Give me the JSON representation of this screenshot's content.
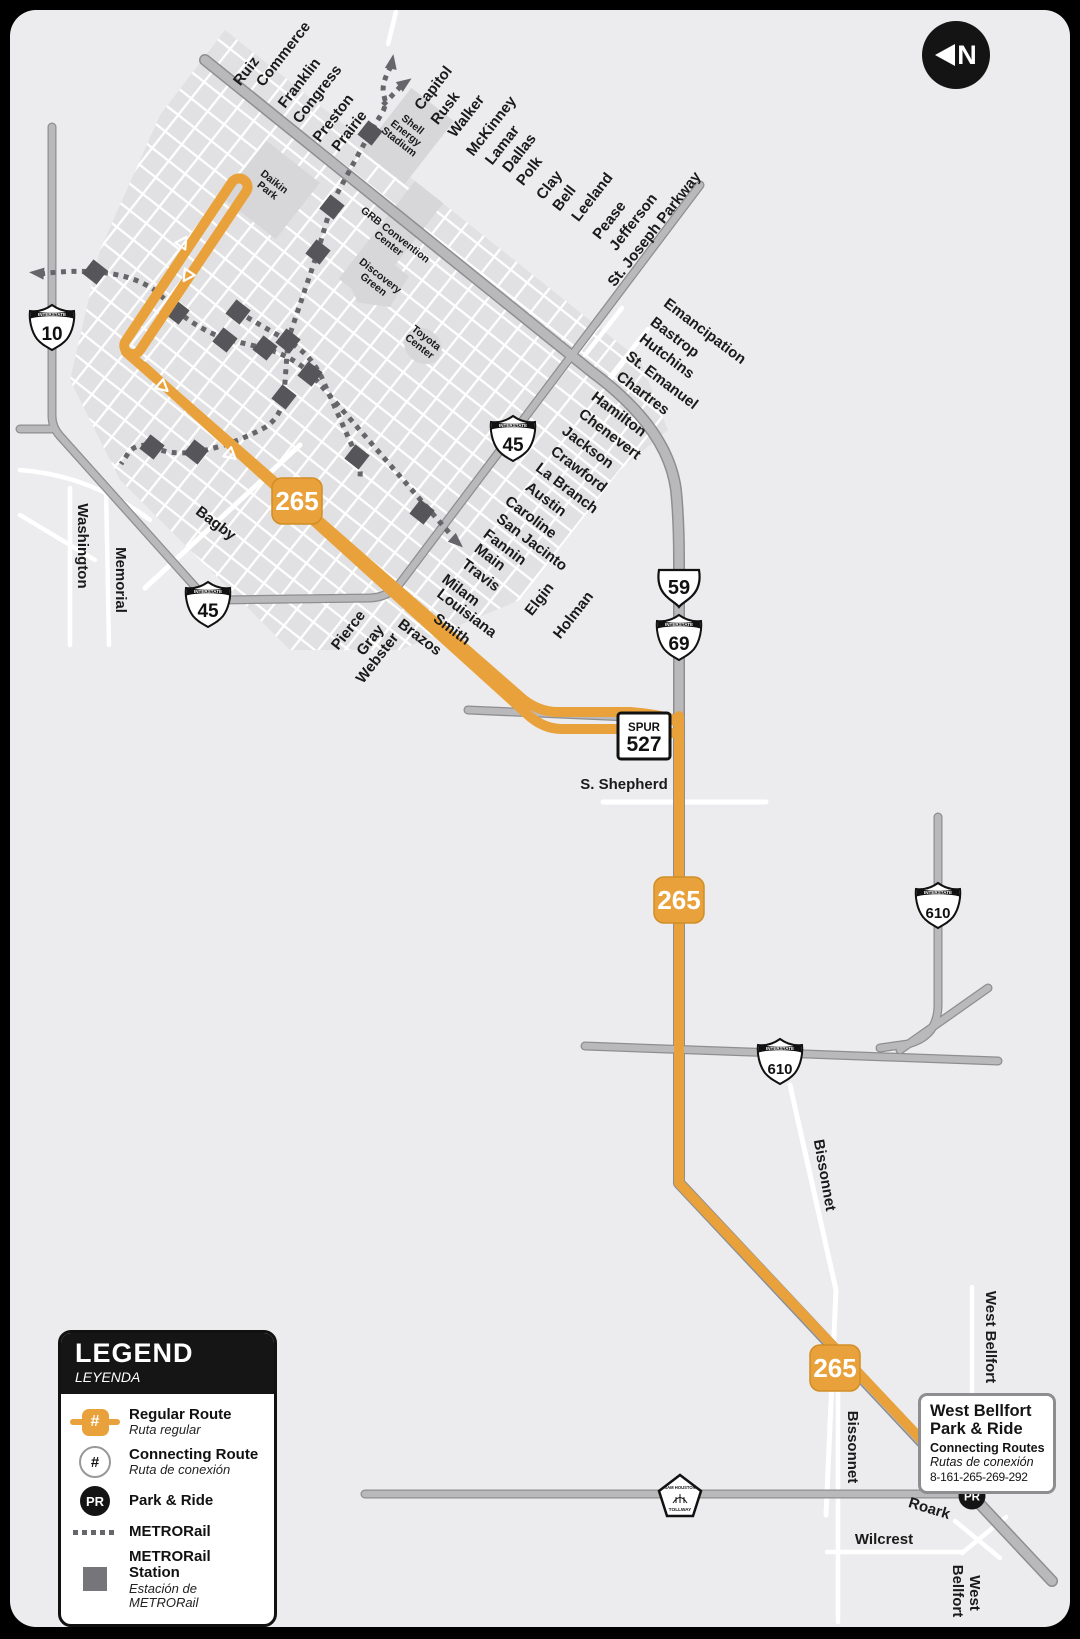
{
  "north": {
    "label": "N"
  },
  "colors": {
    "route_orange": "#E9A23B",
    "badge_border": "#D18E26",
    "road_gray": "#B9B9BC",
    "road_casing": "#8E8E91",
    "rail_gray": "#66666A",
    "map_background": "#ECECEE",
    "block_gray": "#E1E1E3",
    "panel_black": "#141414"
  },
  "legend": {
    "title": "LEGEND",
    "subtitle": "LEYENDA",
    "items": [
      {
        "icon": "regular-route-icon",
        "symbol": "#",
        "label": "Regular Route",
        "sublabel": "Ruta regular"
      },
      {
        "icon": "connecting-route-icon",
        "symbol": "#",
        "label": "Connecting Route",
        "sublabel": "Ruta de conexión"
      },
      {
        "icon": "park-and-ride-icon",
        "symbol": "PR",
        "label": "Park & Ride",
        "sublabel": ""
      },
      {
        "icon": "metrorail-icon",
        "symbol": "",
        "label": "METRORail",
        "sublabel": ""
      },
      {
        "icon": "metrorail-station-icon",
        "symbol": "",
        "label": "METRORail Station",
        "sublabel": "Estación de METRORail"
      }
    ]
  },
  "callout": {
    "line1": "West Bellfort",
    "line2": "Park & Ride",
    "line3": "Connecting Routes",
    "line4": "Rutas de conexión",
    "line5": "8-161-265-269-292"
  },
  "map": {
    "route_number": "265",
    "park_and_ride": {
      "x": 972,
      "y": 1496,
      "label": "PR"
    },
    "route_badges": [
      {
        "x": 297,
        "y": 501
      },
      {
        "x": 679,
        "y": 900
      },
      {
        "x": 835,
        "y": 1368
      }
    ],
    "shields": [
      {
        "type": "interstate",
        "banner": "INTERSTATE",
        "num": "10",
        "x": 52,
        "y": 327
      },
      {
        "type": "interstate",
        "banner": "INTERSTATE",
        "num": "45",
        "x": 513,
        "y": 438
      },
      {
        "type": "interstate",
        "banner": "INTERSTATE",
        "num": "45",
        "x": 208,
        "y": 604
      },
      {
        "type": "us",
        "num": "59",
        "x": 679,
        "y": 587
      },
      {
        "type": "interstate",
        "banner": "INTERSTATE",
        "num": "69",
        "x": 679,
        "y": 637
      },
      {
        "type": "interstate",
        "banner": "INTERSTATE",
        "num": "610",
        "x": 938,
        "y": 905
      },
      {
        "type": "interstate",
        "banner": "INTERSTATE",
        "num": "610",
        "x": 780,
        "y": 1061
      },
      {
        "type": "spur",
        "prefix": "SPUR",
        "num": "527",
        "x": 644,
        "y": 736
      },
      {
        "type": "toll",
        "line1": "SAM HOUSTON",
        "line2": "TOLLWAY",
        "x": 680,
        "y": 1497
      }
    ],
    "street_labels": [
      {
        "text": "Ruiz",
        "x": 250,
        "y": 74,
        "rot": -52
      },
      {
        "text": "Commerce",
        "x": 287,
        "y": 57,
        "rot": -52
      },
      {
        "text": "Franklin",
        "x": 303,
        "y": 86,
        "rot": -52
      },
      {
        "text": "Congress",
        "x": 321,
        "y": 97,
        "rot": -52
      },
      {
        "text": "Preston",
        "x": 337,
        "y": 121,
        "rot": -52
      },
      {
        "text": "Prairie",
        "x": 353,
        "y": 134,
        "rot": -52
      },
      {
        "text": "Capitol",
        "x": 437,
        "y": 91,
        "rot": -52
      },
      {
        "text": "Rusk",
        "x": 449,
        "y": 111,
        "rot": -52
      },
      {
        "text": "Walker",
        "x": 470,
        "y": 119,
        "rot": -52
      },
      {
        "text": "McKinney",
        "x": 495,
        "y": 129,
        "rot": -52
      },
      {
        "text": "Lamar",
        "x": 506,
        "y": 148,
        "rot": -52
      },
      {
        "text": "Dallas",
        "x": 523,
        "y": 156,
        "rot": -52
      },
      {
        "text": "Polk",
        "x": 533,
        "y": 174,
        "rot": -52
      },
      {
        "text": "Clay",
        "x": 553,
        "y": 188,
        "rot": -52
      },
      {
        "text": "Bell",
        "x": 568,
        "y": 201,
        "rot": -52
      },
      {
        "text": "Leeland",
        "x": 596,
        "y": 200,
        "rot": -52
      },
      {
        "text": "Pease",
        "x": 613,
        "y": 223,
        "rot": -52
      },
      {
        "text": "Jefferson",
        "x": 637,
        "y": 225,
        "rot": -52
      },
      {
        "text": "St. Joseph Parkway",
        "x": 658,
        "y": 232,
        "rot": -52
      },
      {
        "text": "Emancipation",
        "x": 702,
        "y": 335,
        "rot": 37
      },
      {
        "text": "Bastrop",
        "x": 672,
        "y": 341,
        "rot": 37
      },
      {
        "text": "Hutchins",
        "x": 664,
        "y": 360,
        "rot": 37
      },
      {
        "text": "St. Emanuel",
        "x": 659,
        "y": 384,
        "rot": 37
      },
      {
        "text": "Chartres",
        "x": 640,
        "y": 397,
        "rot": 37
      },
      {
        "text": "Hamilton",
        "x": 616,
        "y": 418,
        "rot": 37
      },
      {
        "text": "Chenevert",
        "x": 607,
        "y": 438,
        "rot": 37
      },
      {
        "text": "Jackson",
        "x": 585,
        "y": 451,
        "rot": 37
      },
      {
        "text": "Crawford",
        "x": 576,
        "y": 473,
        "rot": 37
      },
      {
        "text": "La Branch",
        "x": 564,
        "y": 492,
        "rot": 37
      },
      {
        "text": "Austin",
        "x": 543,
        "y": 503,
        "rot": 37
      },
      {
        "text": "Caroline",
        "x": 528,
        "y": 521,
        "rot": 37
      },
      {
        "text": "San Jacinto",
        "x": 529,
        "y": 546,
        "rot": 37
      },
      {
        "text": "Fannin",
        "x": 502,
        "y": 551,
        "rot": 37
      },
      {
        "text": "Main",
        "x": 487,
        "y": 561,
        "rot": 37
      },
      {
        "text": "Travis",
        "x": 478,
        "y": 579,
        "rot": 37
      },
      {
        "text": "Milam",
        "x": 458,
        "y": 594,
        "rot": 37
      },
      {
        "text": "Louisiana",
        "x": 464,
        "y": 617,
        "rot": 37
      },
      {
        "text": "Smith",
        "x": 449,
        "y": 633,
        "rot": 37
      },
      {
        "text": "Brazos",
        "x": 417,
        "y": 641,
        "rot": 37
      },
      {
        "text": "Bagby",
        "x": 213,
        "y": 527,
        "rot": 37
      },
      {
        "text": "Pierce",
        "x": 352,
        "y": 633,
        "rot": -52
      },
      {
        "text": "Gray",
        "x": 374,
        "y": 643,
        "rot": -52
      },
      {
        "text": "Webster",
        "x": 381,
        "y": 661,
        "rot": -52
      },
      {
        "text": "Elgin",
        "x": 543,
        "y": 602,
        "rot": -52
      },
      {
        "text": "Holman",
        "x": 577,
        "y": 618,
        "rot": -52
      },
      {
        "text": "Washington",
        "x": 78,
        "y": 546,
        "rot": 90
      },
      {
        "text": "Memorial",
        "x": 116,
        "y": 580,
        "rot": 90
      },
      {
        "text": "S. Shepherd",
        "x": 624,
        "y": 789,
        "rot": 0
      },
      {
        "text": "Bissonnet",
        "x": 820,
        "y": 1176,
        "rot": 80
      },
      {
        "text": "Bissonnet",
        "x": 848,
        "y": 1447,
        "rot": 90
      },
      {
        "text": "West Bellfort",
        "x": 986,
        "y": 1337,
        "rot": 90
      },
      {
        "text": "Roark",
        "x": 928,
        "y": 1513,
        "rot": 17
      },
      {
        "text": "Wilcrest",
        "x": 884,
        "y": 1544,
        "rot": 0
      },
      {
        "text": "Bellfort",
        "x": 953,
        "y": 1591,
        "rot": 90
      },
      {
        "text": "West",
        "x": 970,
        "y": 1593,
        "rot": 90
      }
    ],
    "landmark_labels": [
      {
        "lines": [
          "Daikin",
          "Park"
        ],
        "x": 271,
        "y": 186,
        "rot": 38
      },
      {
        "lines": [
          "Shell",
          "Energy",
          "Stadium"
        ],
        "x": 406,
        "y": 133,
        "rot": 38
      },
      {
        "lines": [
          "GRB Convention",
          "Center"
        ],
        "x": 392,
        "y": 239,
        "rot": 38
      },
      {
        "lines": [
          "Discovery",
          "Green"
        ],
        "x": 377,
        "y": 280,
        "rot": 38
      },
      {
        "lines": [
          "Toyota",
          "Center"
        ],
        "x": 423,
        "y": 342,
        "rot": 38
      }
    ],
    "rail_stations": [
      {
        "x": 370,
        "y": 133
      },
      {
        "x": 332,
        "y": 207
      },
      {
        "x": 318,
        "y": 252
      },
      {
        "x": 288,
        "y": 341
      },
      {
        "x": 284,
        "y": 397
      },
      {
        "x": 238,
        "y": 312
      },
      {
        "x": 177,
        "y": 312
      },
      {
        "x": 95,
        "y": 272
      },
      {
        "x": 225,
        "y": 340
      },
      {
        "x": 265,
        "y": 348
      },
      {
        "x": 310,
        "y": 374
      },
      {
        "x": 196,
        "y": 452
      },
      {
        "x": 152,
        "y": 447
      },
      {
        "x": 357,
        "y": 457
      },
      {
        "x": 422,
        "y": 512
      }
    ]
  }
}
